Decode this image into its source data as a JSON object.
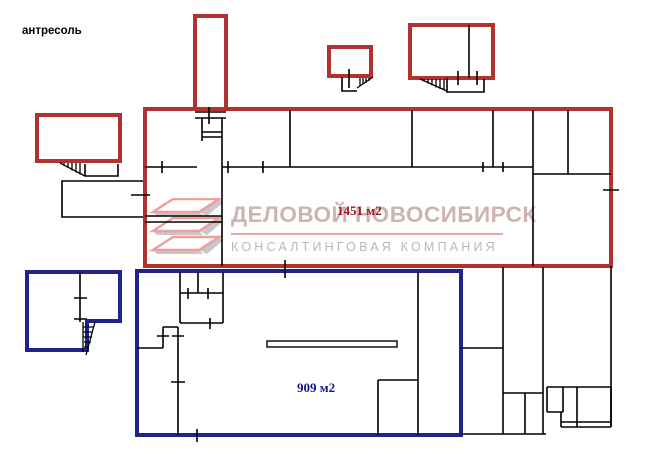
{
  "page": {
    "label_mezzanine": "антресоль"
  },
  "areas": {
    "red": {
      "label": "1451 м2"
    },
    "blue": {
      "label": "909 м2"
    }
  },
  "watermark": {
    "company": "ДЕЛОВОЙ НОВОСИБИРСК",
    "tagline": "КОНСАЛТИНГОВАЯ КОМПАНИЯ"
  },
  "colors": {
    "outline_red": "#b23131",
    "outline_blue": "#22228c",
    "wall": "#000000",
    "area_red_text": "#a01616",
    "area_blue_text": "#16168c",
    "wm_title": "#cfb3b3",
    "wm_tagline": "#b8b8b8",
    "wm_underline": "#e8a6a6",
    "logo_pink": "#ef9e9e",
    "logo_gray": "#c8c8c8",
    "background": "#ffffff"
  }
}
